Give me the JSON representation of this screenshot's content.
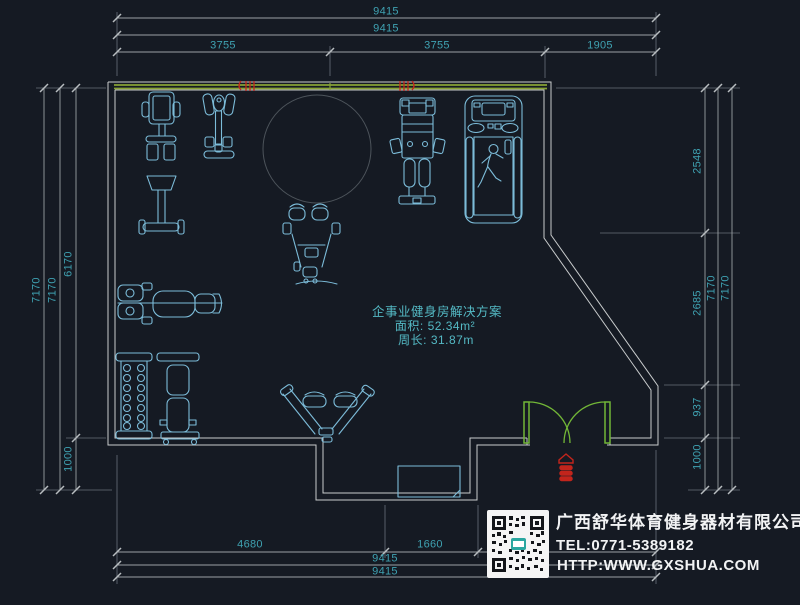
{
  "drawing": {
    "type": "cad-floor-plan",
    "background": "#151a23"
  },
  "room_info": {
    "title": "企事业健身房解决方案",
    "area": "面积: 52.34m²",
    "perimeter": "周长: 31.87m"
  },
  "company": {
    "name": "广西舒华体育健身器材有限公司",
    "tel": "TEL:0771-5389182",
    "website": "HTTP:WWW.GXSHUA.COM",
    "qr": "qr-code"
  },
  "dimensions": {
    "unit": "mm",
    "top": [
      "9415",
      "9415",
      "3755",
      "3755",
      "1905"
    ],
    "left": [
      "7170",
      "7170",
      "6170",
      "1000"
    ],
    "right": [
      "2548",
      "2685",
      "937",
      "1000",
      "7170",
      "7170"
    ],
    "bottom": [
      "4680",
      "1660",
      "9415",
      "9415"
    ]
  },
  "equipment": [
    "vertical-press-machine",
    "elliptical-trainer",
    "column-circle",
    "pec-deck-machine",
    "multi-station-machine",
    "treadmill-with-runner",
    "bench-press",
    "dumbbell-rack",
    "adjustable-bench",
    "v-row-machine",
    "alcove-desk"
  ],
  "markers": {
    "door": "double-swing-door",
    "entrance_symbol": "red-entrance-marker",
    "wall_vent_count": 2
  },
  "colors": {
    "background": "#151a23",
    "wall_gray": "#c9cccd",
    "wall_green": "#86a135",
    "door_green": "#72b637",
    "dimension_line": "#9aa0a4",
    "dimension_text": "#3fa2b2",
    "equipment_blue": "#7cbcd9",
    "alert_red": "#c2251c",
    "company_text": "#f2f3f4"
  }
}
